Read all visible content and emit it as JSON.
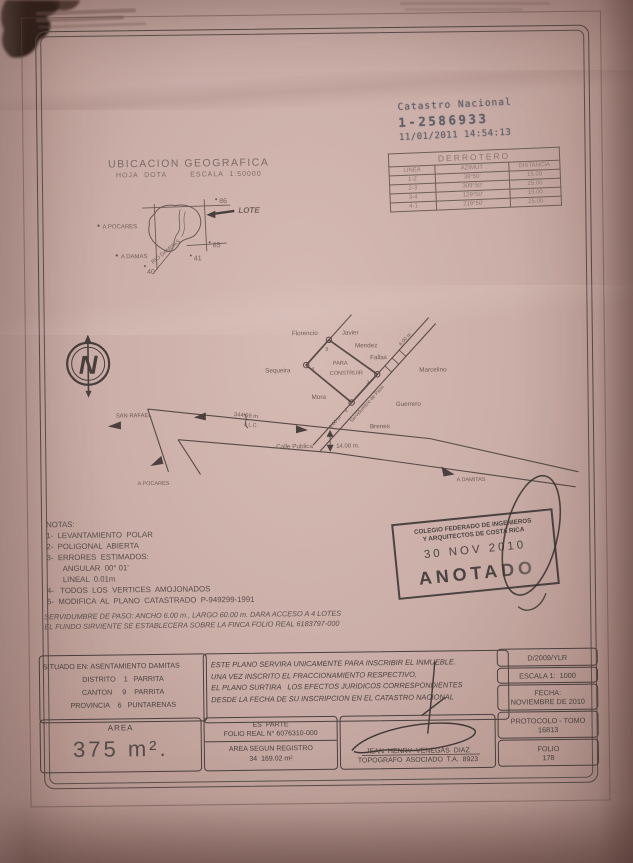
{
  "header_stamps": {
    "catastro": {
      "title": "Catastro Nacional",
      "number": "1-2586933",
      "datetime": "11/01/2011 14:54:13"
    }
  },
  "ubicacion": {
    "title": "UBICACION  GEOGRAFICA",
    "subtitle": "HOJA  DOTA        ESCALA  1:50000",
    "lote": "LOTE",
    "grid_86": "86",
    "grid_85": "85",
    "grid_40": "40",
    "grid_41": "41",
    "a_pocares": "A  POCARES",
    "a_damas": "A  DAMAS",
    "rio": "RIO DAMITAS"
  },
  "derrotero": {
    "title": "DERROTERO",
    "headers": [
      "LINEA",
      "AZIMUT",
      "DISTANCIA"
    ],
    "rows": [
      [
        "1-2",
        "39°50'",
        "15.00"
      ],
      [
        "2-3",
        "309°50'",
        "25.00"
      ],
      [
        "3-4",
        "129°50'",
        "15.00"
      ],
      [
        "4-1",
        "219°50'",
        "25.00"
      ]
    ]
  },
  "compass": {
    "letter": "N"
  },
  "plan": {
    "neighbors": {
      "florencio": "Florencio",
      "javier": "Javier",
      "mendez": "Mendez",
      "fallas": "Fallas",
      "sequeira": "Sequeira",
      "mora": "Mora",
      "marcelino": "Marcelino",
      "guerrero": "Guerrero",
      "brenes": "Brenes"
    },
    "parcel_line1": "PARA",
    "parcel_line2": "CONSTRUIR",
    "v1": "1",
    "v2": "2",
    "v3": "3",
    "v4": "4",
    "easement": "Servidumbre de Paso",
    "easement_width": "6.00 m",
    "easement_width2": "6.00 m",
    "san_rafael": "SAN  RAFAEL",
    "road_distance": "344.59  m.",
    "road_to": "a  L.C.",
    "street": "Calle  Publica",
    "street_width": "14.00  m.",
    "a_pocares": "A  POCARES",
    "a_damitas": "A  DAMITAS"
  },
  "notas": {
    "title": "NOTAS:",
    "items": [
      "1-  LEVANTAMIENTO  POLAR",
      "2-  POLIGONAL  ABIERTA",
      "3-  ERRORES  ESTIMADOS:",
      "ANGULAR  00° 01'",
      "LINEAL  0.01m",
      "4-   TODOS  LOS  VERTICES  AMOJONADOS",
      "5-  MODIFICA  AL  PLANO  CATASTRADO  P-949299-1991"
    ],
    "servidumbre_line1": "SERVIDUMBRE DE PASO: ANCHO 6.00 m., LARGO 60.00 m. DARA ACCESO A 4 LOTES",
    "servidumbre_line2": "EL FUNDO SIRVIENTE SE ESTABLECERA SOBRE LA FINCA FOLIO REAL 6183797-000"
  },
  "cfia_stamp": {
    "org_line1": "COLEGIO FEDERADO DE INGENIEROS",
    "org_line2": "Y ARQUITECTOS DE COSTA RICA",
    "date": "30 NOV 2010",
    "status": "ANOTADO"
  },
  "info": {
    "situado_line1": "SITUADO EN: ASENTAMIENTO DAMITAS",
    "situado_line2": "DISTRITO    1   PARRITA",
    "situado_line3": "CANTON     9    PARRITA",
    "situado_line4": "PROVINCIA    6   PUNTARENAS",
    "legal_lines": [
      "ESTE PLANO SERVIRA UNICAMENTE PARA INSCRIBIR EL INMUEBLE.",
      "UNA VEZ INSCRITO EL FRACCIONAMIENTO RESPECTIVO,",
      "EL PLANO SURTIRA   LOS EFECTOS JURIDICOS CORRESPONDIENTES",
      "DESDE LA FECHA DE SU INSCRIPCION EN EL CATASTRO NACIONAL"
    ],
    "ref": "D/2009/YLR",
    "escala": "ESCALA 1:  1000",
    "fecha_label": "FECHA:",
    "fecha_value": "NOVIEMBRE DE 2010",
    "protocolo_label": "PROTOCOLO - TOMO",
    "protocolo_value": "16813",
    "folio_label": "FOLIO",
    "folio_value": "178",
    "area_label": "AREA",
    "area_value": "375 m².",
    "es_parte_label": "ES  PARTE",
    "folio_real": "FOLIO REAL N° 6076310-000",
    "area_registro_label": "AREA SEGUN REGISTRO",
    "area_registro_value": "34  169.02 m²",
    "surveyor_name": "JEAN  HENRY  VENEGAS  DIAZ",
    "surveyor_title": "TOPOGRAFO  ASOCIADO  T.A.  8923"
  }
}
